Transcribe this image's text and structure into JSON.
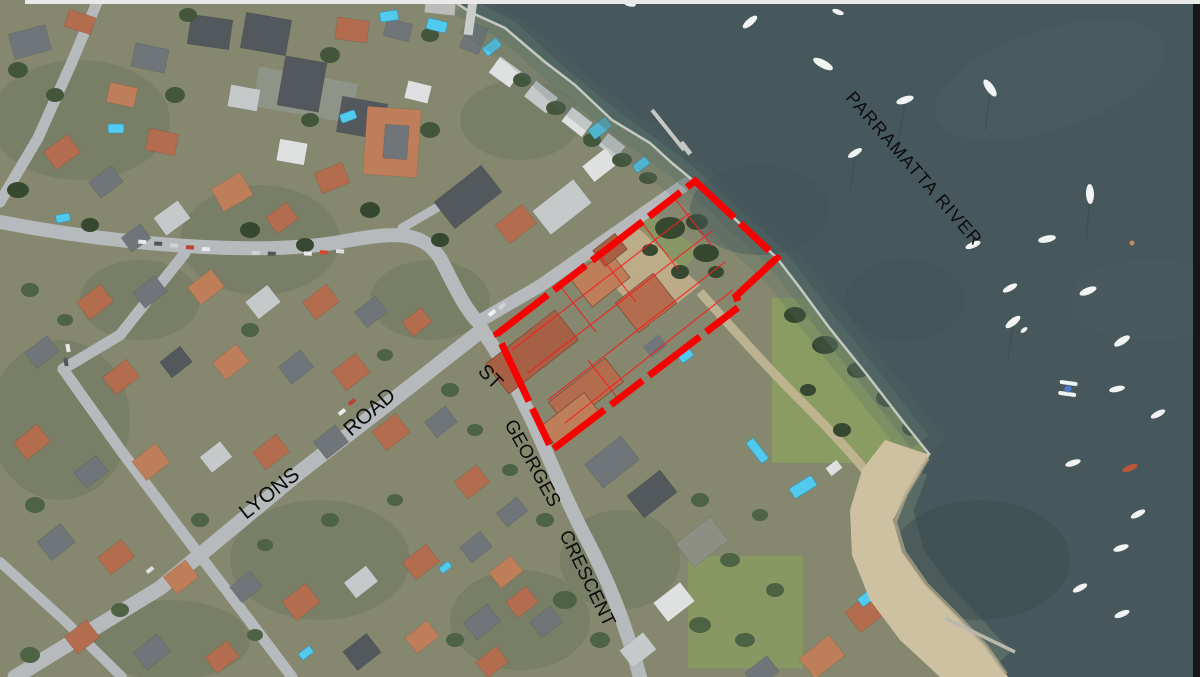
{
  "labels": {
    "river": "PARRAMATTA RIVER",
    "lyons_word1": "LYONS",
    "lyons_word2": "ROAD",
    "stg_word1": "ST",
    "stg_word2": "GEORGES",
    "stg_word3": "CRESCENT"
  },
  "site": {
    "polygon_points": "497,334 695,181 777,258 736,296 740,306 552,450",
    "outline_color": "#FF0000"
  },
  "colors": {
    "water": "#46585C",
    "land": "#85886e",
    "road": "#b6babc",
    "roof_terracotta": "#b56b4c",
    "roof_grey": "#6f7578",
    "tree": "#42563b",
    "pool": "#4ecbf0",
    "sand": "#cfc1a0",
    "label_text": "#0c0c0c"
  }
}
